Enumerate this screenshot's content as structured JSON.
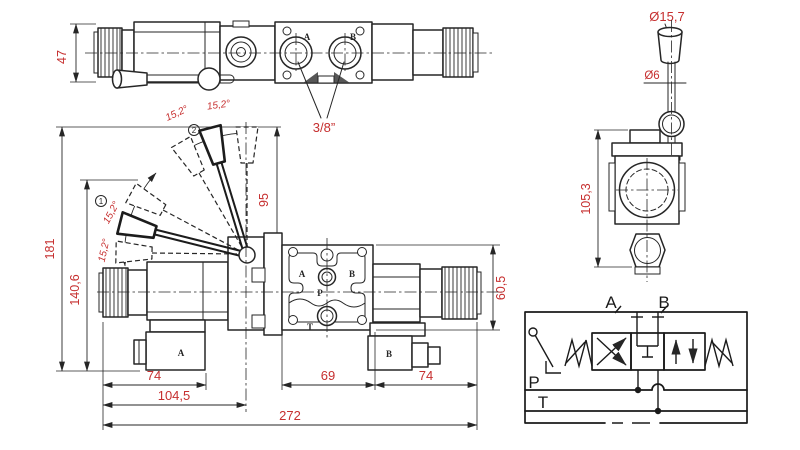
{
  "colors": {
    "line_color": "#262626",
    "dimension_color": "#c62f2f",
    "background": "#ffffff"
  },
  "top_view": {
    "dim_height": "47",
    "port_a_label": "A",
    "port_b_label": "B",
    "thread_label": "3/8”"
  },
  "front_view": {
    "dim_overall_height": "181",
    "dim_coil_height": "140,6",
    "dim_lever_height": "95",
    "angle_top_left": "15,2°",
    "angle_top_right": "15,2°",
    "angle_left_upper": "15,2°",
    "angle_left_lower": "15,2°",
    "position_1": "1",
    "position_2": "2",
    "connector_a_label": "A",
    "connector_b_label": "B",
    "port_a_label": "A",
    "port_b_label": "B",
    "port_p_label": "P",
    "port_t_label": "T",
    "dim_left_coil": "74",
    "dim_valve_body": "69",
    "dim_right_coil": "74",
    "dim_to_lever_axis": "104,5",
    "dim_overall_width": "272",
    "dim_valve_height": "60,5"
  },
  "side_view": {
    "dim_knob_diameter": "Ø15,7",
    "dim_shaft_diameter": "Ø6",
    "dim_height": "105,3"
  },
  "schematic": {
    "port_a": "A",
    "port_b": "B",
    "port_p": "P",
    "port_t": "T"
  }
}
